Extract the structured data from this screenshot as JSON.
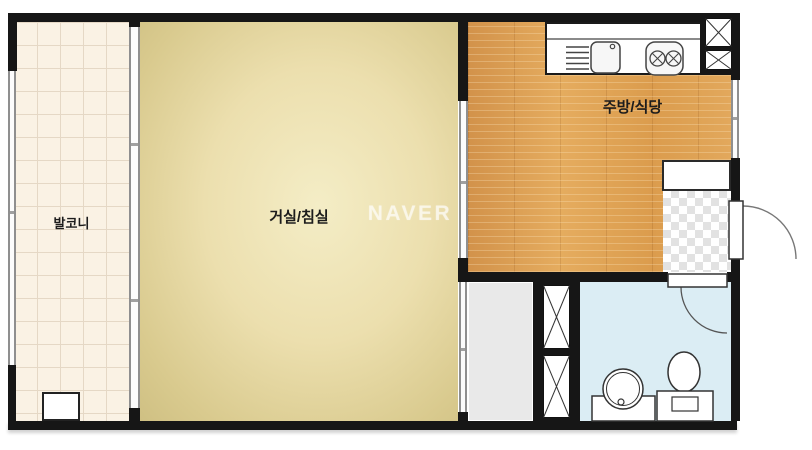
{
  "plan": {
    "title": "one-room apartment floor plan",
    "watermark": "NAVER",
    "rooms": {
      "balcony": "발코니",
      "living_bedroom": "거실/침실",
      "kitchen_dining": "주방/식당"
    },
    "fixtures": [
      "kitchen-sink",
      "gas-stove-2-burner",
      "dish-rack",
      "duct-shaft-top",
      "duct-shaft-bottom",
      "shoe-cabinet",
      "entrance-door",
      "bathroom-door",
      "washbasin",
      "toilet",
      "washer-box",
      "window",
      "sliding-door"
    ],
    "colors": {
      "wall": "#161616",
      "balcony_tile": "#faf2e4",
      "balcony_grid": "#e5d8c5",
      "living_center": "#f4edc6",
      "living_edge": "#cfc083",
      "kitchen_wood": "#dfa253",
      "bathroom_blue": "#dbedf4",
      "closet_gray": "#e9e9e9",
      "checker_gray": "#e2e2e2",
      "watermark_color": "#ffffff"
    }
  }
}
